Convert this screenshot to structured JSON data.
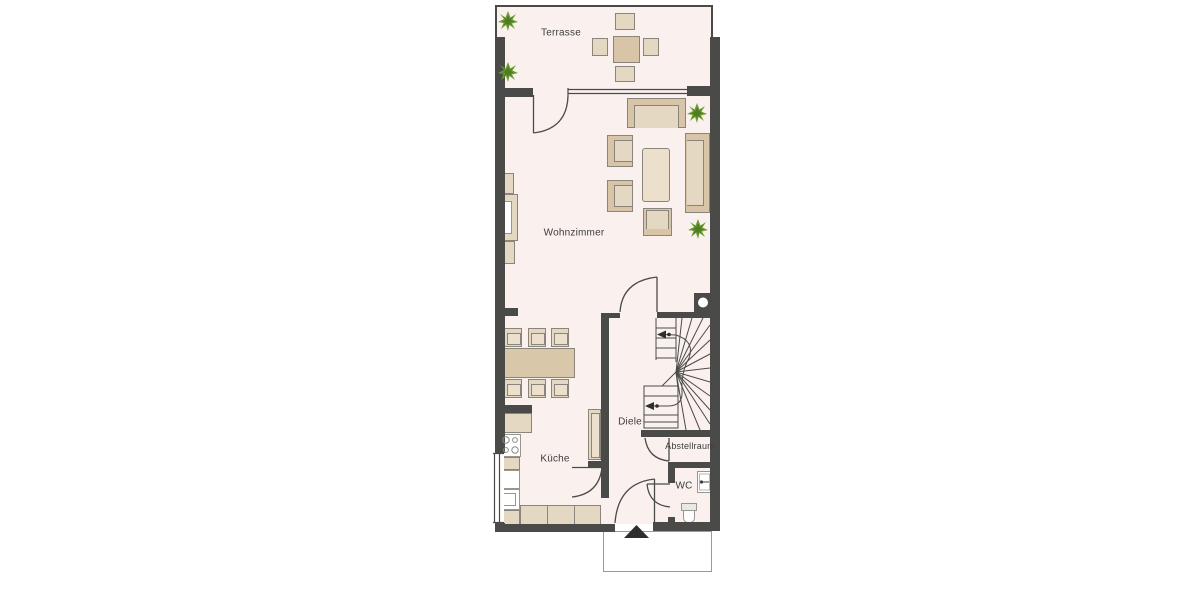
{
  "title": "Erdgeschoss Grundriss",
  "rooms": [
    {
      "id": "terrasse",
      "label": "Terrasse"
    },
    {
      "id": "wohnzimmer",
      "label": "Wohnzimmer"
    },
    {
      "id": "kueche",
      "label": "Küche"
    },
    {
      "id": "diele",
      "label": "Diele"
    },
    {
      "id": "abstellraum",
      "label": "Abstellraum"
    },
    {
      "id": "wc",
      "label": "WC"
    }
  ],
  "colors": {
    "wall": "#4a4a48",
    "room_fill": "#faf1ef",
    "furniture": "#d8c5a8",
    "furniture_light": "#e5d8c2",
    "table": "#d9c7a9",
    "plant_green": "#6d9c33",
    "plant_green_dark": "#4e7d22",
    "outline": "#8a857c",
    "label_text": "#3c3c3c",
    "background": "#ffffff"
  },
  "features": {
    "plants_count": 4,
    "entrance_marker": "black triangle arrow",
    "stair_type": "winder staircase",
    "kitchen_fixtures": [
      "stove-4-burners",
      "sink"
    ],
    "wc_fixtures": [
      "washbasin",
      "toilet"
    ]
  }
}
